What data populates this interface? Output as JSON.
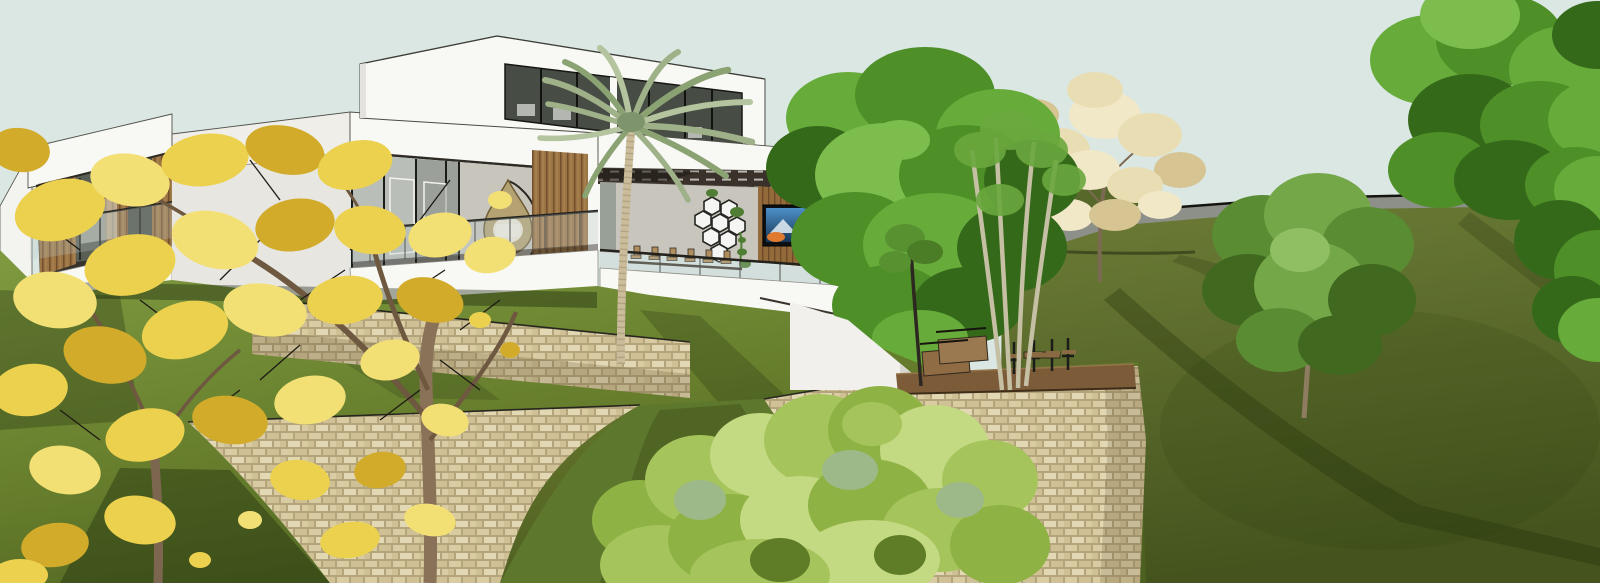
{
  "scene": {
    "type": "3d-architectural-rendering",
    "subject": "Modern flat-roof hillside villa with glass facades, wood slat panels, open living pavilion, stone retaining walls and landscaped slope",
    "objects": [
      "sky",
      "background-hill",
      "hillcrest-road",
      "pale-flowering-tree",
      "top-right-tree",
      "right-edge-foliage",
      "mid-right-tree",
      "left-annex-wall",
      "left-wing",
      "main-volume",
      "upper-volume",
      "open-pavilion",
      "teardrop-hanging-chair",
      "hex-wall-shelves",
      "wall-tv",
      "pergola",
      "glass-railing",
      "palm-tree",
      "big-green-tree",
      "pale-trunk-tree",
      "lawn",
      "upper-retaining-wall",
      "lower-retaining-wall",
      "right-retaining-wall",
      "grass-swale",
      "wood-deck-terrace",
      "bench-steps",
      "outdoor-dining-set",
      "foreground-shrub",
      "yellow-trumpet-tree"
    ]
  },
  "palette": {
    "sky": "#dbe7e3",
    "road_gray": "#8d9089",
    "road_line": "#14140e",
    "hill_light": "#6e7e37",
    "hill_dark": "#45541e",
    "lawn_light": "#7f9a40",
    "lawn_dark": "#4c6120",
    "grass_shadow": "#15200a",
    "stone_a": "#d9cca2",
    "stone_b": "#cfc095",
    "stone_c": "#e3d8b4",
    "stone_mortar": "#b3a47c",
    "house_white": "#f8f8f4",
    "house_shade": "#efeee9",
    "soffit_dark": "#2e2a24",
    "wood_slat": "#9c7444",
    "wood_slat_dark": "#72502e",
    "wall_gray": "#c8c5bd",
    "glass_gray": "#b9beb8",
    "window_dark": "#474c45",
    "frame_black": "#20201c",
    "palm_frond": "#9fb188",
    "palm_trunk": "#cbbd9c",
    "green_1": "#4e8f28",
    "green_2": "#67ab3a",
    "green_3": "#35691a",
    "green_4": "#7cbd4e",
    "bush_1": "#a6c45c",
    "bush_2": "#8fb244",
    "bush_3": "#c3d982",
    "sage": "#9db98a",
    "pale_blossom": "#e9ddb4",
    "yellow_1": "#ecd14f",
    "yellow_2": "#f3e075",
    "yellow_3": "#d2ab2b",
    "branch_dark": "#1d1a14",
    "trunk_brown": "#8a7258",
    "deck_wood": "#7c5c38",
    "bench_wood": "#8f6c44",
    "tv_accent_orange": "#e07a2f",
    "chair_black": "#1c1c1a",
    "wicker": "#b5a272",
    "pale_trunks": "#c5bfa4"
  }
}
